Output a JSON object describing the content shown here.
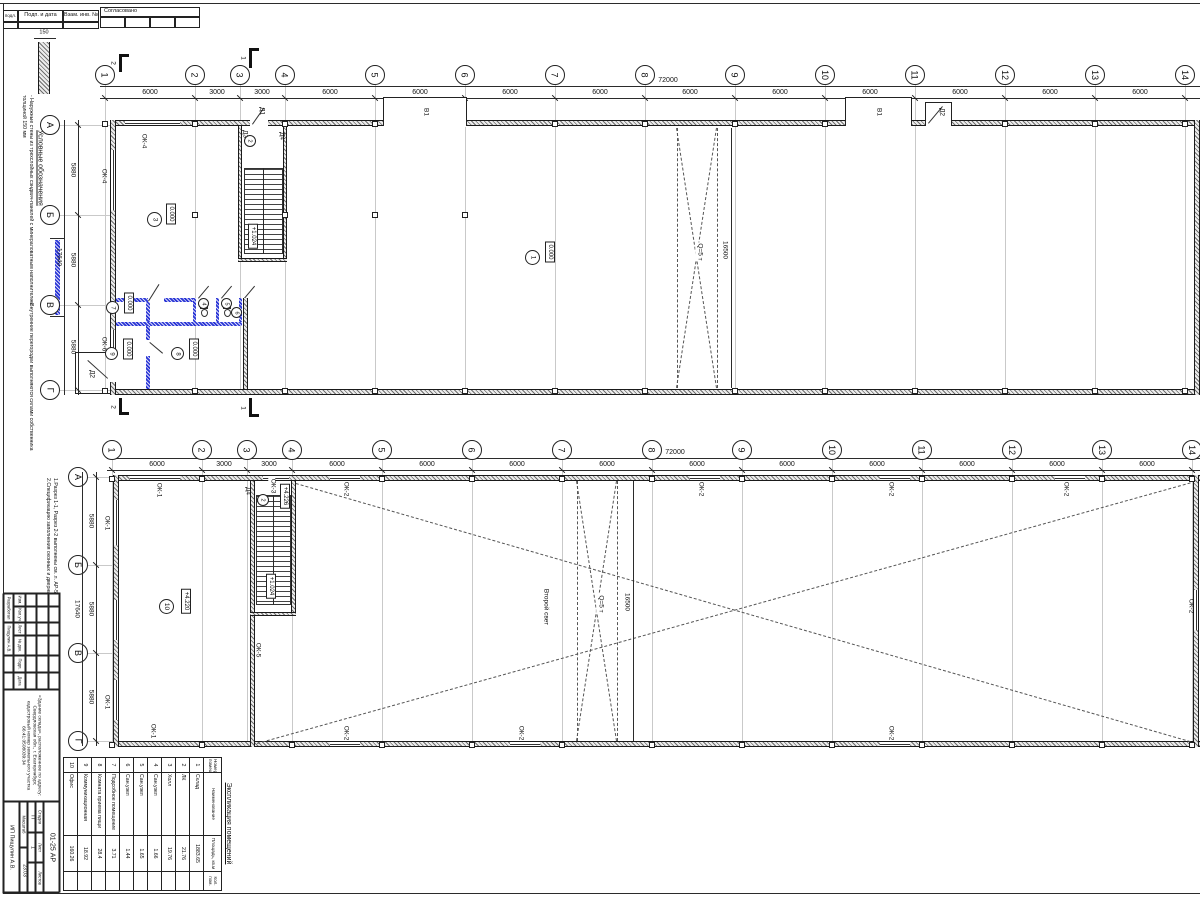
{
  "frame": {
    "col1": "подл.",
    "col2": "Подп. и дата",
    "col3": "Взам. инв. №",
    "approved": "Согласовано"
  },
  "legend": {
    "title": "Условные обозначения",
    "wall_dim": "150",
    "item_ext": "- Наружные стены из трехслойных сэндвич-панелей с минераловатным наполнителем толщиной 150 мм",
    "item_int": "- Внутренние перегородки выполняются силами собственника"
  },
  "notes": {
    "line1": "1.Разрез 1-1, Разрез 2-2 выполнены см. л. АР-5",
    "line2": "2.Спецификацию заполнения оконных и дверных проемов см. л. АР-5"
  },
  "axes": {
    "cols": [
      "1",
      "2",
      "3",
      "4",
      "5",
      "6",
      "7",
      "8",
      "9",
      "10",
      "11",
      "12",
      "13",
      "14"
    ],
    "col_dims": [
      "6000",
      "3000",
      "3000",
      "6000",
      "6000",
      "6000",
      "6000",
      "6000",
      "6000",
      "6000",
      "6000",
      "6000",
      "6000"
    ],
    "total": "72000",
    "rows": [
      "А",
      "Б",
      "В",
      "Г"
    ],
    "row_dims": [
      "5880",
      "5880",
      "5880"
    ],
    "row_total": "17640",
    "bay": "16500"
  },
  "sections": {
    "s1": "1",
    "s2": "2"
  },
  "plan1": {
    "rooms": {
      "hall": {
        "num": "3",
        "level": "0.000"
      },
      "warehouse": {
        "num": "1",
        "level": "0.000"
      },
      "stair": {
        "num": "2",
        "level": "+1.024"
      },
      "r7": {
        "num": "7",
        "level": "0.000"
      },
      "r9": {
        "num": "9",
        "level": "0.000"
      },
      "r8": {
        "num": "8",
        "level": "0.000"
      },
      "wc1": {
        "num": "4"
      },
      "wc2": {
        "num": "5"
      },
      "wc3": {
        "num": "6"
      }
    },
    "labels": {
      "ok4": "ОК-4",
      "ok6": "ОК-6",
      "d1": "Д1",
      "d2": "Д2",
      "d3": "Д3",
      "d4": "Д4",
      "v1": "В1",
      "crane": "Q=5 т"
    }
  },
  "plan2": {
    "rooms": {
      "office": {
        "num": "10",
        "level": "+4.220"
      },
      "stair": {
        "num": "2",
        "level": "+4.226",
        "mid": "+1.024"
      }
    },
    "labels": {
      "ok1": "ОК-1",
      "ok2": "ОК-2",
      "ok3": "ОК-3",
      "ok5": "ОК-5",
      "d4": "Д4",
      "crane": "Q=5 т",
      "void": "Второй свет"
    }
  },
  "explication": {
    "title": "Экспликация помещений",
    "headers": [
      "Номер помещ.",
      "Наименование",
      "Площадь, кв.м",
      "Кол. пом."
    ],
    "rows": [
      [
        "1",
        "Склад",
        "1883.65"
      ],
      [
        "2",
        "ЛК",
        "21.76"
      ],
      [
        "3",
        "Холл",
        "19.76"
      ],
      [
        "4",
        "Сан.узел",
        "1.66"
      ],
      [
        "5",
        "Сан.узел",
        "1.65"
      ],
      [
        "6",
        "Сан.узел",
        "1.44"
      ],
      [
        "7",
        "Подсобное помещение",
        "3.71"
      ],
      [
        "8",
        "Комната приема пищи",
        "28.4"
      ],
      [
        "9",
        "Коммуникационная",
        "18.92"
      ],
      [
        "10",
        "Офис",
        "160.26"
      ]
    ]
  },
  "stamp": {
    "cols": [
      "Изм.",
      "Кол.уч",
      "Лист",
      "№ док.",
      "Подп.",
      "Дата"
    ],
    "dev_label": "Разработал",
    "dev_name": "Пищулин А.В.",
    "object": "«Здание склада», расположенное по адресу: Свердловская обл., г. Екатеринбург, кадастровый номер земельного участка 66:41:0508039:34",
    "doc": "01-25 АР",
    "stage_label": "Стадия",
    "sheet_label": "Лист",
    "sheets_label": "Листов",
    "stage": "П",
    "sheet": "1",
    "sheets": "",
    "scale_label": "Масштаб",
    "scale": "23.03",
    "company": "ИП Пищулин А.В."
  }
}
